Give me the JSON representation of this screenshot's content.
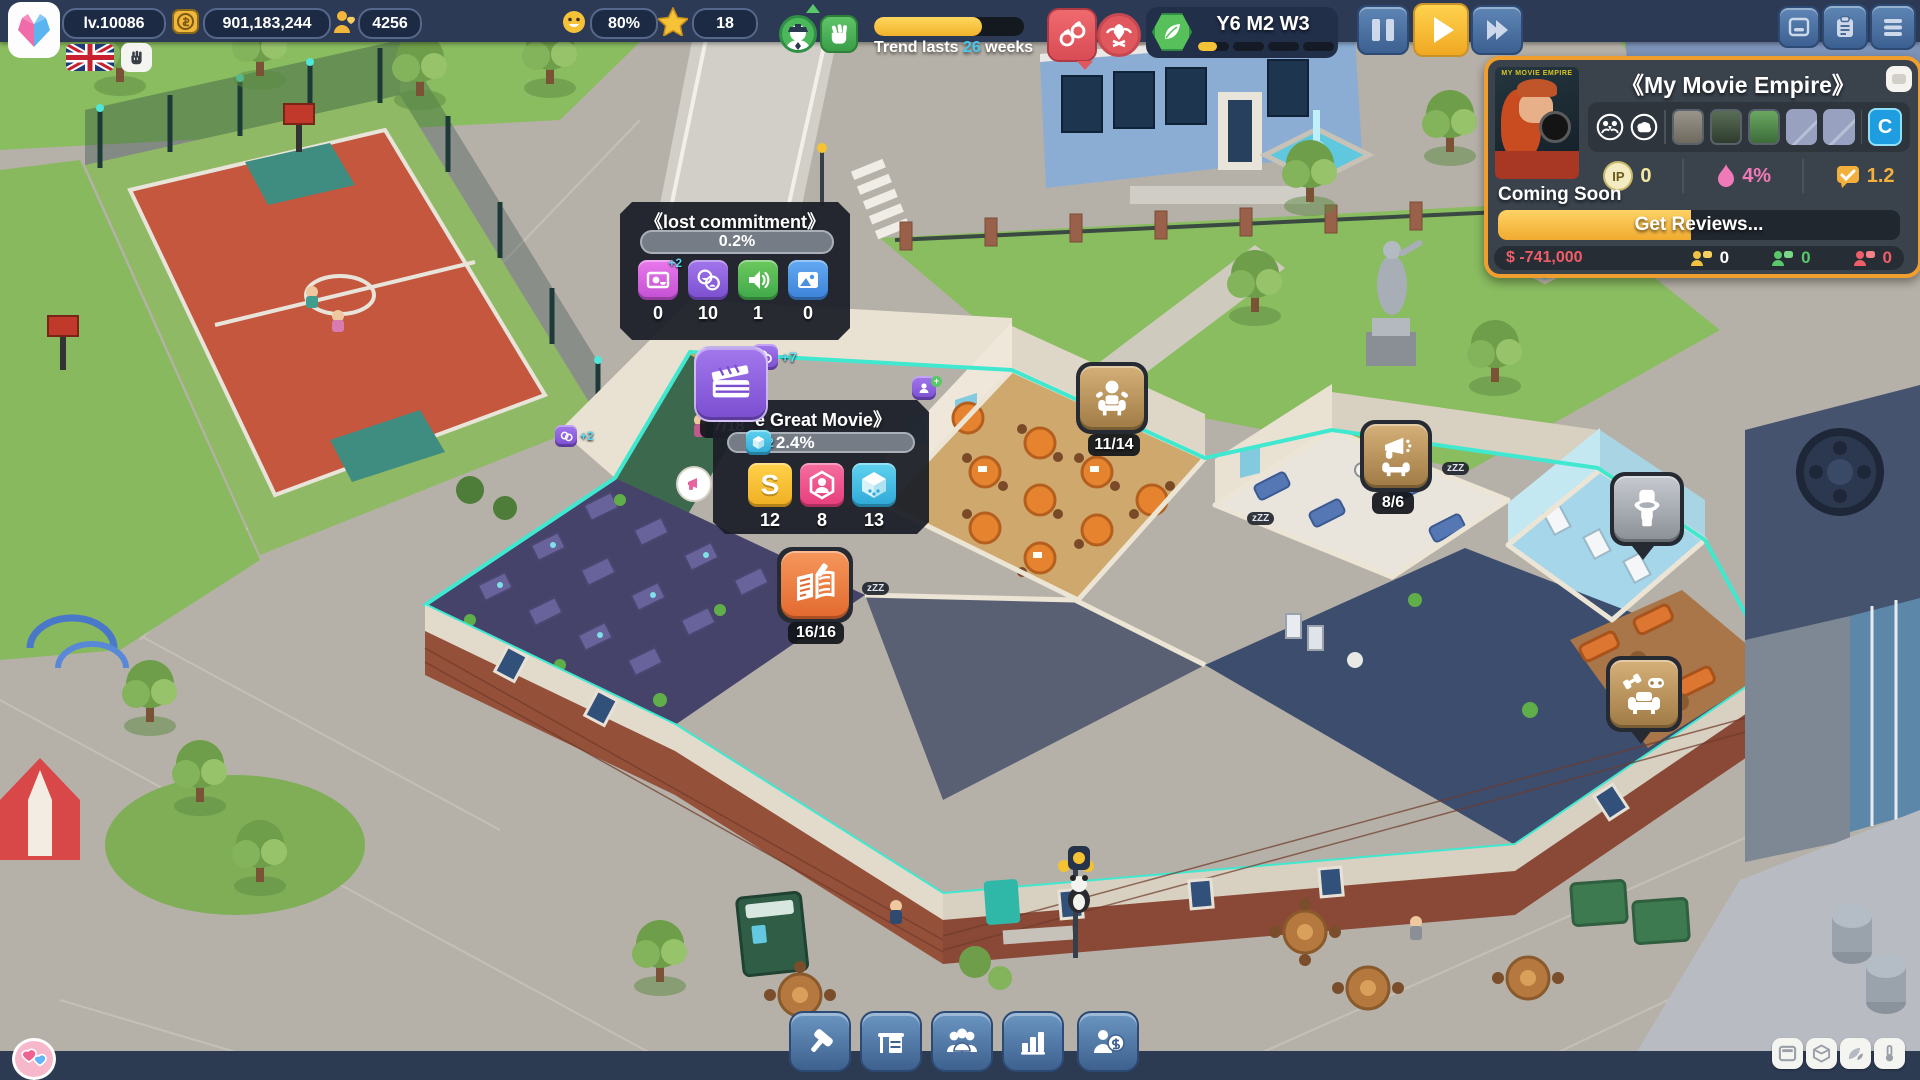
{
  "colors": {
    "accent_yellow": "#f6c238",
    "accent_cyan": "#49c8f0",
    "teal_highlight": "#3fe8cf",
    "panel_border": "#f09e2e",
    "danger_red": "#ef5d68",
    "green": "#58c868"
  },
  "top_bar": {
    "level": "lv.10086",
    "money": "901,183,244",
    "fans": "4256",
    "happiness": "80%",
    "stars": "18",
    "trend": {
      "prefix": "Trend lasts ",
      "weeks": "26",
      "suffix": " weeks"
    },
    "date": "Y6 M2 W3"
  },
  "movie_panel": {
    "title": "《My Movie Empire》",
    "poster_title": "MY MOVIE EMPIRE",
    "c_button": "C",
    "ip_label": "IP",
    "ip_value": "0",
    "heat_value": "4%",
    "rating_value": "1.2",
    "status": "Coming Soon",
    "action": "Get Reviews...",
    "budget": "$ -741,000",
    "audience": [
      {
        "value": "0"
      },
      {
        "value": "0"
      },
      {
        "value": "0"
      }
    ]
  },
  "lost_commitment": {
    "title": "《lost commitment》",
    "progress": "0.2%",
    "items": [
      {
        "value": "0",
        "badge": "+2"
      },
      {
        "value": "10"
      },
      {
        "value": "1"
      },
      {
        "value": "0"
      }
    ],
    "float_bonus": "+7"
  },
  "great_movie": {
    "title": "e Great Movie》",
    "clapper": "7/18",
    "bonus": "+2",
    "progress": "2.4%",
    "s_glyph": "S",
    "items": [
      {
        "value": "12"
      },
      {
        "value": "8"
      },
      {
        "value": "13"
      }
    ]
  },
  "rooms": {
    "writers": "11/14",
    "marketing": "8/6",
    "script": "16/16"
  },
  "scene": {
    "zzz": "zZZ",
    "bonus_star": "+2"
  }
}
